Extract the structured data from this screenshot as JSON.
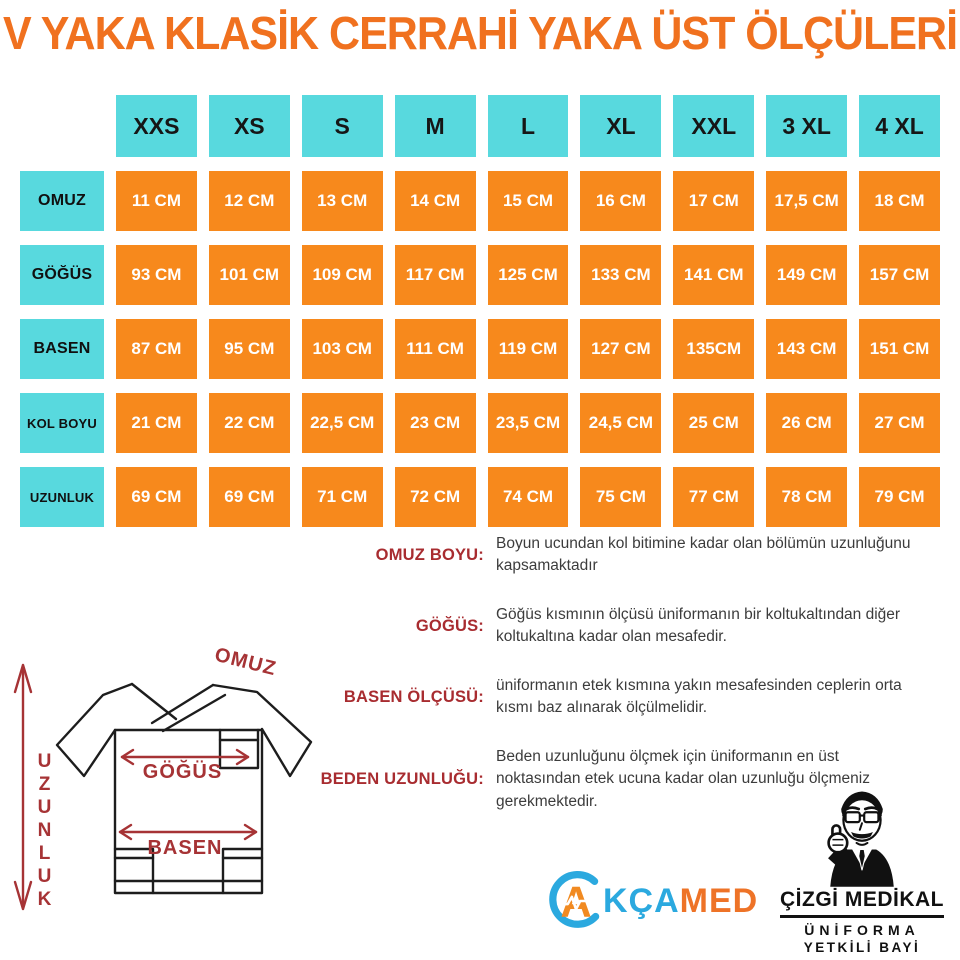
{
  "title": "V YAKA KLASİK CERRAHİ YAKA ÜST ÖLÇÜLERİ",
  "colors": {
    "title_orange": "#F0711F",
    "cell_orange": "#F7891C",
    "header_cyan": "#58D9DE",
    "definition_red": "#A82C30",
    "diagram_red": "#A63335",
    "body_text": "#3C3C3C"
  },
  "size_table": {
    "columns": [
      "XXS",
      "XS",
      "S",
      "M",
      "L",
      "XL",
      "XXL",
      "3 XL",
      "4 XL"
    ],
    "rows": [
      {
        "label": "OMUZ",
        "values": [
          "11 CM",
          "12 CM",
          "13 CM",
          "14 CM",
          "15 CM",
          "16 CM",
          "17 CM",
          "17,5 CM",
          "18 CM"
        ]
      },
      {
        "label": "GÖĞÜS",
        "values": [
          "93 CM",
          "101 CM",
          "109 CM",
          "117 CM",
          "125 CM",
          "133 CM",
          "141 CM",
          "149 CM",
          "157 CM"
        ]
      },
      {
        "label": "BASEN",
        "values": [
          "87 CM",
          "95 CM",
          "103 CM",
          "111 CM",
          "119 CM",
          "127 CM",
          "135CM",
          "143 CM",
          "151 CM"
        ]
      },
      {
        "label": "KOL BOYU",
        "values": [
          "21 CM",
          "22 CM",
          "22,5 CM",
          "23 CM",
          "23,5 CM",
          "24,5 CM",
          "25 CM",
          "26 CM",
          "27 CM"
        ]
      },
      {
        "label": "UZUNLUK",
        "values": [
          "69 CM",
          "69 CM",
          "71 CM",
          "72 CM",
          "74 CM",
          "75 CM",
          "77 CM",
          "78 CM",
          "79 CM"
        ]
      }
    ]
  },
  "definitions": [
    {
      "term": "OMUZ BOYU:",
      "text": "Boyun ucundan kol bitimine kadar olan bölümün uzunluğunu kapsamaktadır"
    },
    {
      "term": "GÖĞÜS:",
      "text": "Göğüs kısmının ölçüsü üniformanın bir koltukaltından diğer koltukaltına kadar olan mesafedir."
    },
    {
      "term": "BASEN ÖLÇÜSÜ:",
      "text": "üniformanın etek kısmına yakın mesafesinden ceplerin orta kısmı baz alınarak ölçülmelidir."
    },
    {
      "term": "BEDEN UZUNLUĞU:",
      "text": "Beden uzunluğunu ölçmek için üniformanın en üst noktasından etek ucuna kadar olan uzunluğu ölçmeniz gerekmektedir."
    }
  ],
  "diagram": {
    "labels": {
      "omuz": "OMUZ",
      "gogus": "GÖĞÜS",
      "basen": "BASEN",
      "uzunluk": "UZUNLUK"
    }
  },
  "logos": {
    "akcamed": {
      "a": "A",
      "kca": "KÇA",
      "med": "MED"
    },
    "cizgi": {
      "name": "ÇİZGİ MEDİKAL",
      "line2": "ÜNİFORMA",
      "line3": "YETKİLİ BAYİ"
    }
  }
}
